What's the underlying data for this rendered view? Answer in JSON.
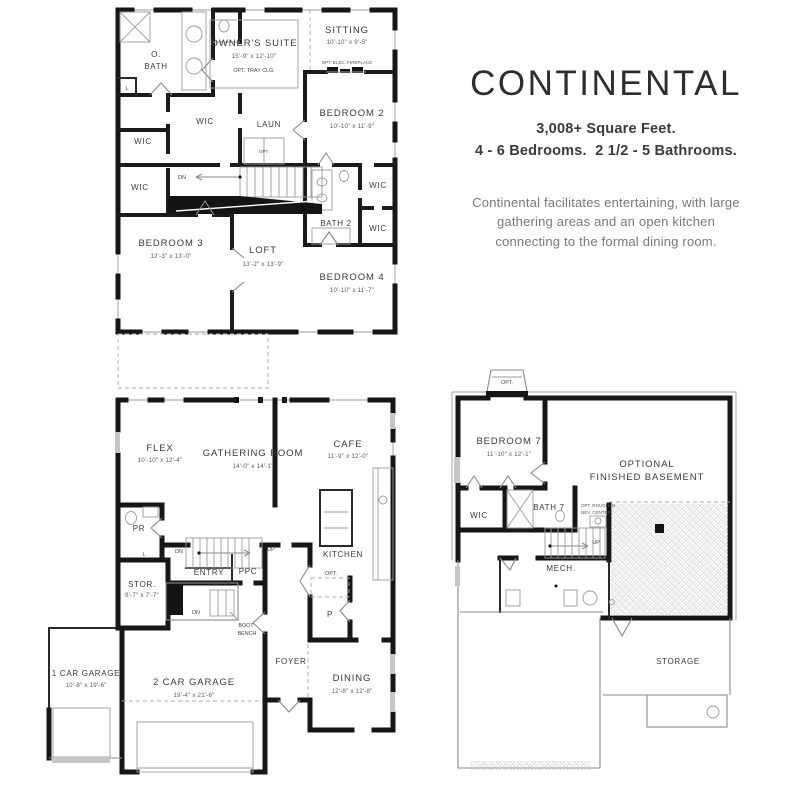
{
  "header": {
    "title": "CONTINENTAL",
    "square_feet": "3,008+ Square Feet.",
    "beds_baths": "4 - 6 Bedrooms.  2 1/2 - 5 Bathrooms.",
    "desc1": "Continental facilitates entertaining, with large",
    "desc2": "gathering areas and an open kitchen",
    "desc3": "connecting to the formal dining room."
  },
  "labels": {
    "wic": "WIC",
    "dn": "DN",
    "up": "UP",
    "opt": "OPT.",
    "l": "L",
    "p": "P"
  },
  "floor2": {
    "o_bath_l1": "O.",
    "o_bath_l2": "BATH",
    "owners_suite": "OWNER'S SUITE",
    "owners_suite_dims": "15'-9\" x 12'-10\"",
    "owners_suite_note": "OPT. TRAY CLG.",
    "sitting": "SITTING",
    "sitting_dims": "10'-10\" x 9'-5\"",
    "fireplace_note": "OPT. ELEC. FIREPLACE",
    "laun": "LAUN",
    "bedroom2": "BEDROOM 2",
    "bedroom2_dims": "10'-10\" x 11'-9\"",
    "bath2": "BATH 2",
    "bedroom3": "BEDROOM 3",
    "bedroom3_dims": "12'-3\" x 13'-0\"",
    "loft": "LOFT",
    "loft_dims": "13'-2\" x 13'-9\"",
    "bedroom4": "BEDROOM 4",
    "bedroom4_dims": "10'-10\" x 11'-7\""
  },
  "floor1": {
    "flex": "FLEX",
    "flex_dims": "10'-10\" x 12'-4\"",
    "gathering": "GATHERING ROOM",
    "gathering_dims": "14'-0\" x 14'-1\"",
    "cafe": "CAFE",
    "cafe_dims": "11'-9\" x 12'-0\"",
    "kitchen": "KITCHEN",
    "pr": "PR",
    "stor": "STOR.",
    "stor_dims": "8'-7\" x 7'-7\"",
    "entry": "ENTRY",
    "ppc": "PPC",
    "boot_l1": "BOOT",
    "boot_l2": "BENCH",
    "foyer": "FOYER",
    "dining": "DINING",
    "dining_dims": "12'-8\" x 12'-8\"",
    "garage2": "2 CAR GARAGE",
    "garage2_dims": "19'-4\" x 21'-6\"",
    "garage1": "1 CAR GARAGE",
    "garage1_dims": "10'-8\" x 19'-6\""
  },
  "basement": {
    "bedroom7": "BEDROOM 7",
    "bedroom7_dims": "11'-10\" x 12'-1\"",
    "optional_l1": "OPTIONAL",
    "optional_l2": "FINISHED BASEMENT",
    "bath7": "BATH 7",
    "bev_l1": "OPT. ROUGH-IN",
    "bev_l2": "BEV. CENTER",
    "mech": "MECH.",
    "storage": "STORAGE"
  }
}
